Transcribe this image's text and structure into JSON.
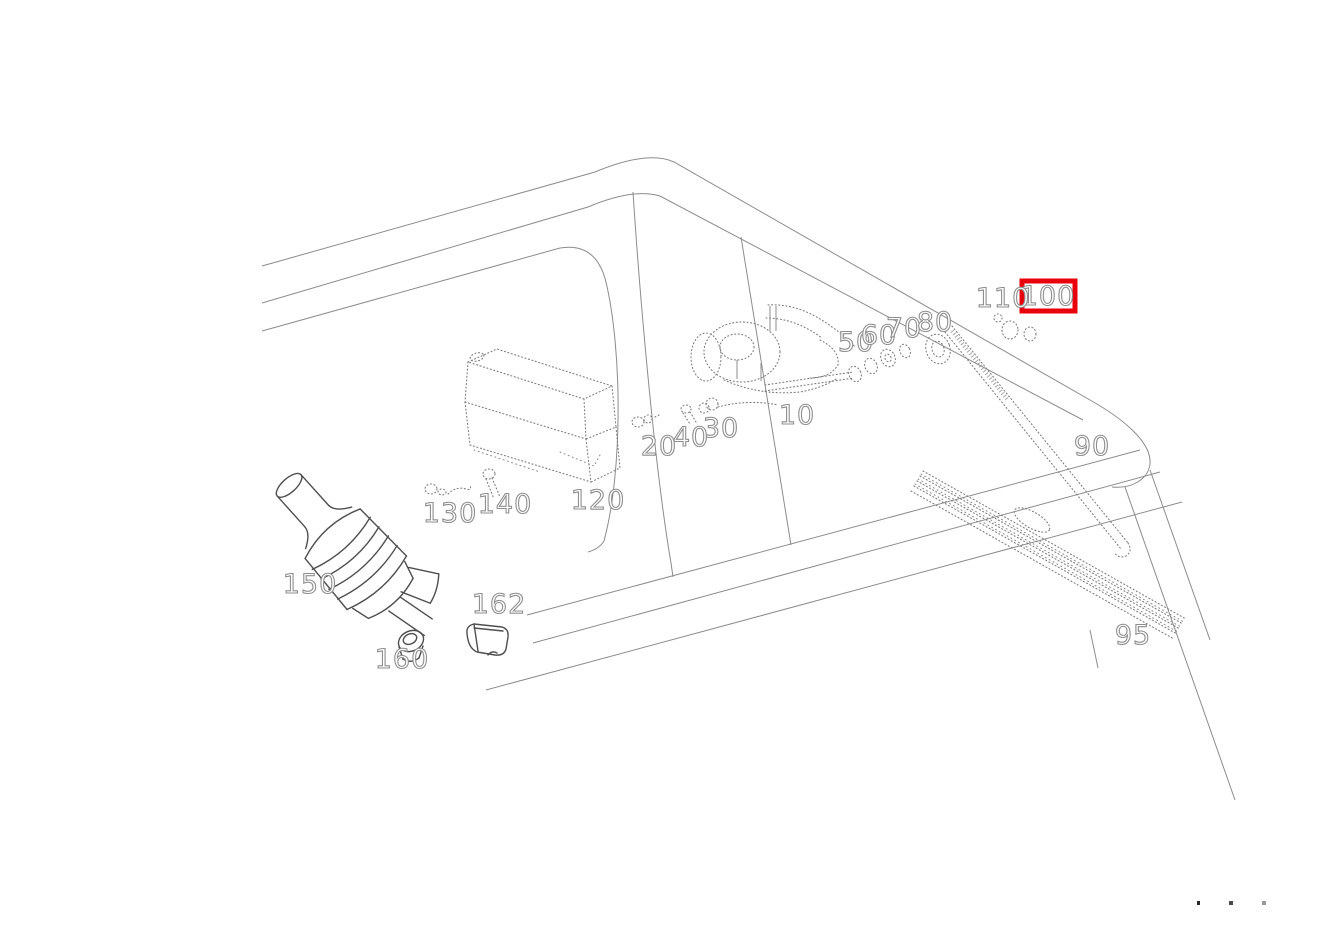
{
  "diagram": {
    "kind": "exploded-parts-line-drawing",
    "subject": "windshield wiper and washer system on vehicle front body",
    "highlighted_part": "100",
    "highlight_color": "#e8000d",
    "line_color": "#7e7e7e",
    "background": "#ffffff"
  },
  "parts": [
    {
      "number": "10",
      "selected": false
    },
    {
      "number": "20",
      "selected": false
    },
    {
      "number": "30",
      "selected": false
    },
    {
      "number": "40",
      "selected": false
    },
    {
      "number": "50",
      "selected": false
    },
    {
      "number": "60",
      "selected": false
    },
    {
      "number": "70",
      "selected": false
    },
    {
      "number": "80",
      "selected": false
    },
    {
      "number": "90",
      "selected": false
    },
    {
      "number": "95",
      "selected": false
    },
    {
      "number": "100",
      "selected": true
    },
    {
      "number": "110",
      "selected": false
    },
    {
      "number": "120",
      "selected": false
    },
    {
      "number": "130",
      "selected": false
    },
    {
      "number": "140",
      "selected": false
    },
    {
      "number": "150",
      "selected": false
    },
    {
      "number": "160",
      "selected": false
    },
    {
      "number": "162",
      "selected": false
    }
  ],
  "footer": {
    "dots_count": 3
  }
}
